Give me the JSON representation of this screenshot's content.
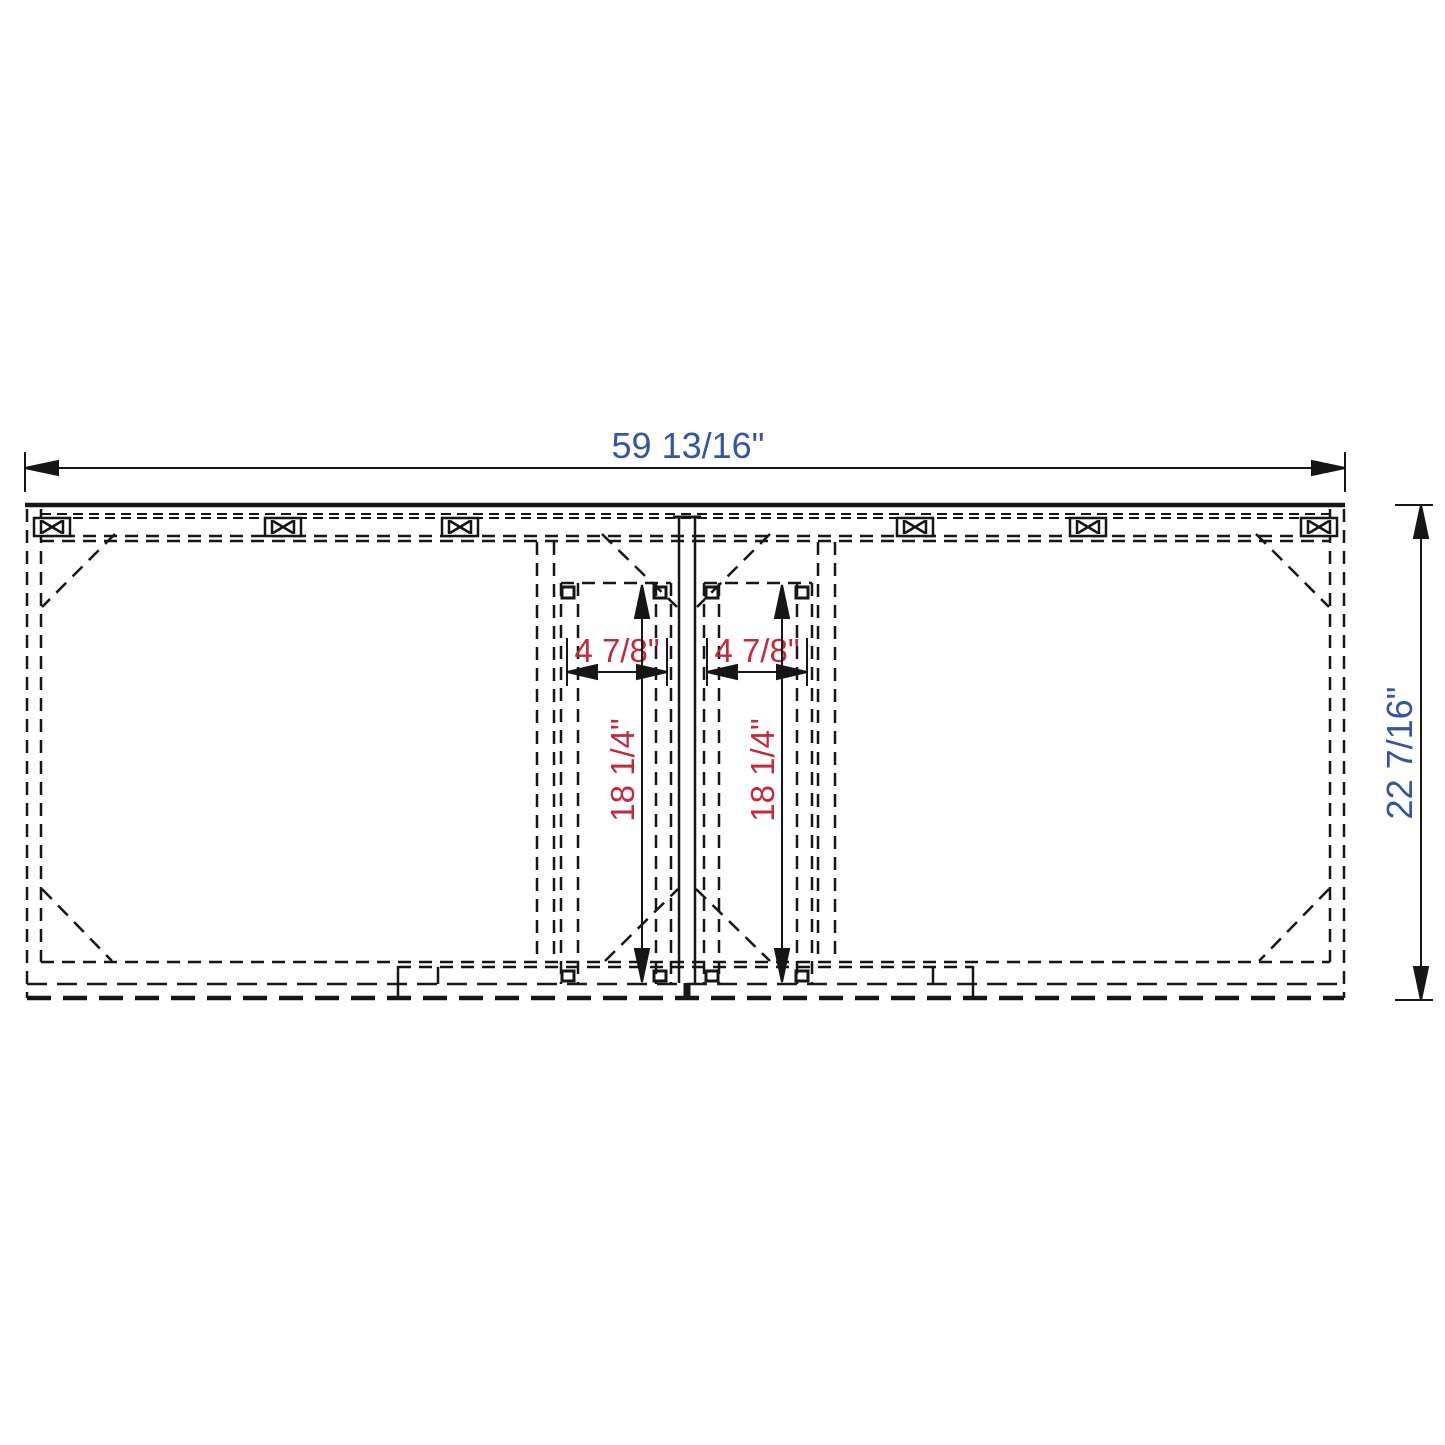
{
  "drawing": {
    "type_note": "cabinet-vanity-front-technical-drawing",
    "overall_width_label": "59 13/16\"",
    "overall_depth_label": "22 7/16\"",
    "left_opening_width_label": "4 7/8\"",
    "right_opening_width_label": "4 7/8\"",
    "left_opening_height_label": "18 1/4\"",
    "right_opening_height_label": "18 1/4\"",
    "colors": {
      "primary_dimension_text": "#3354a8",
      "secondary_dimension_text": "#c42a3c",
      "line": "#161616",
      "background": "#ffffff"
    }
  }
}
